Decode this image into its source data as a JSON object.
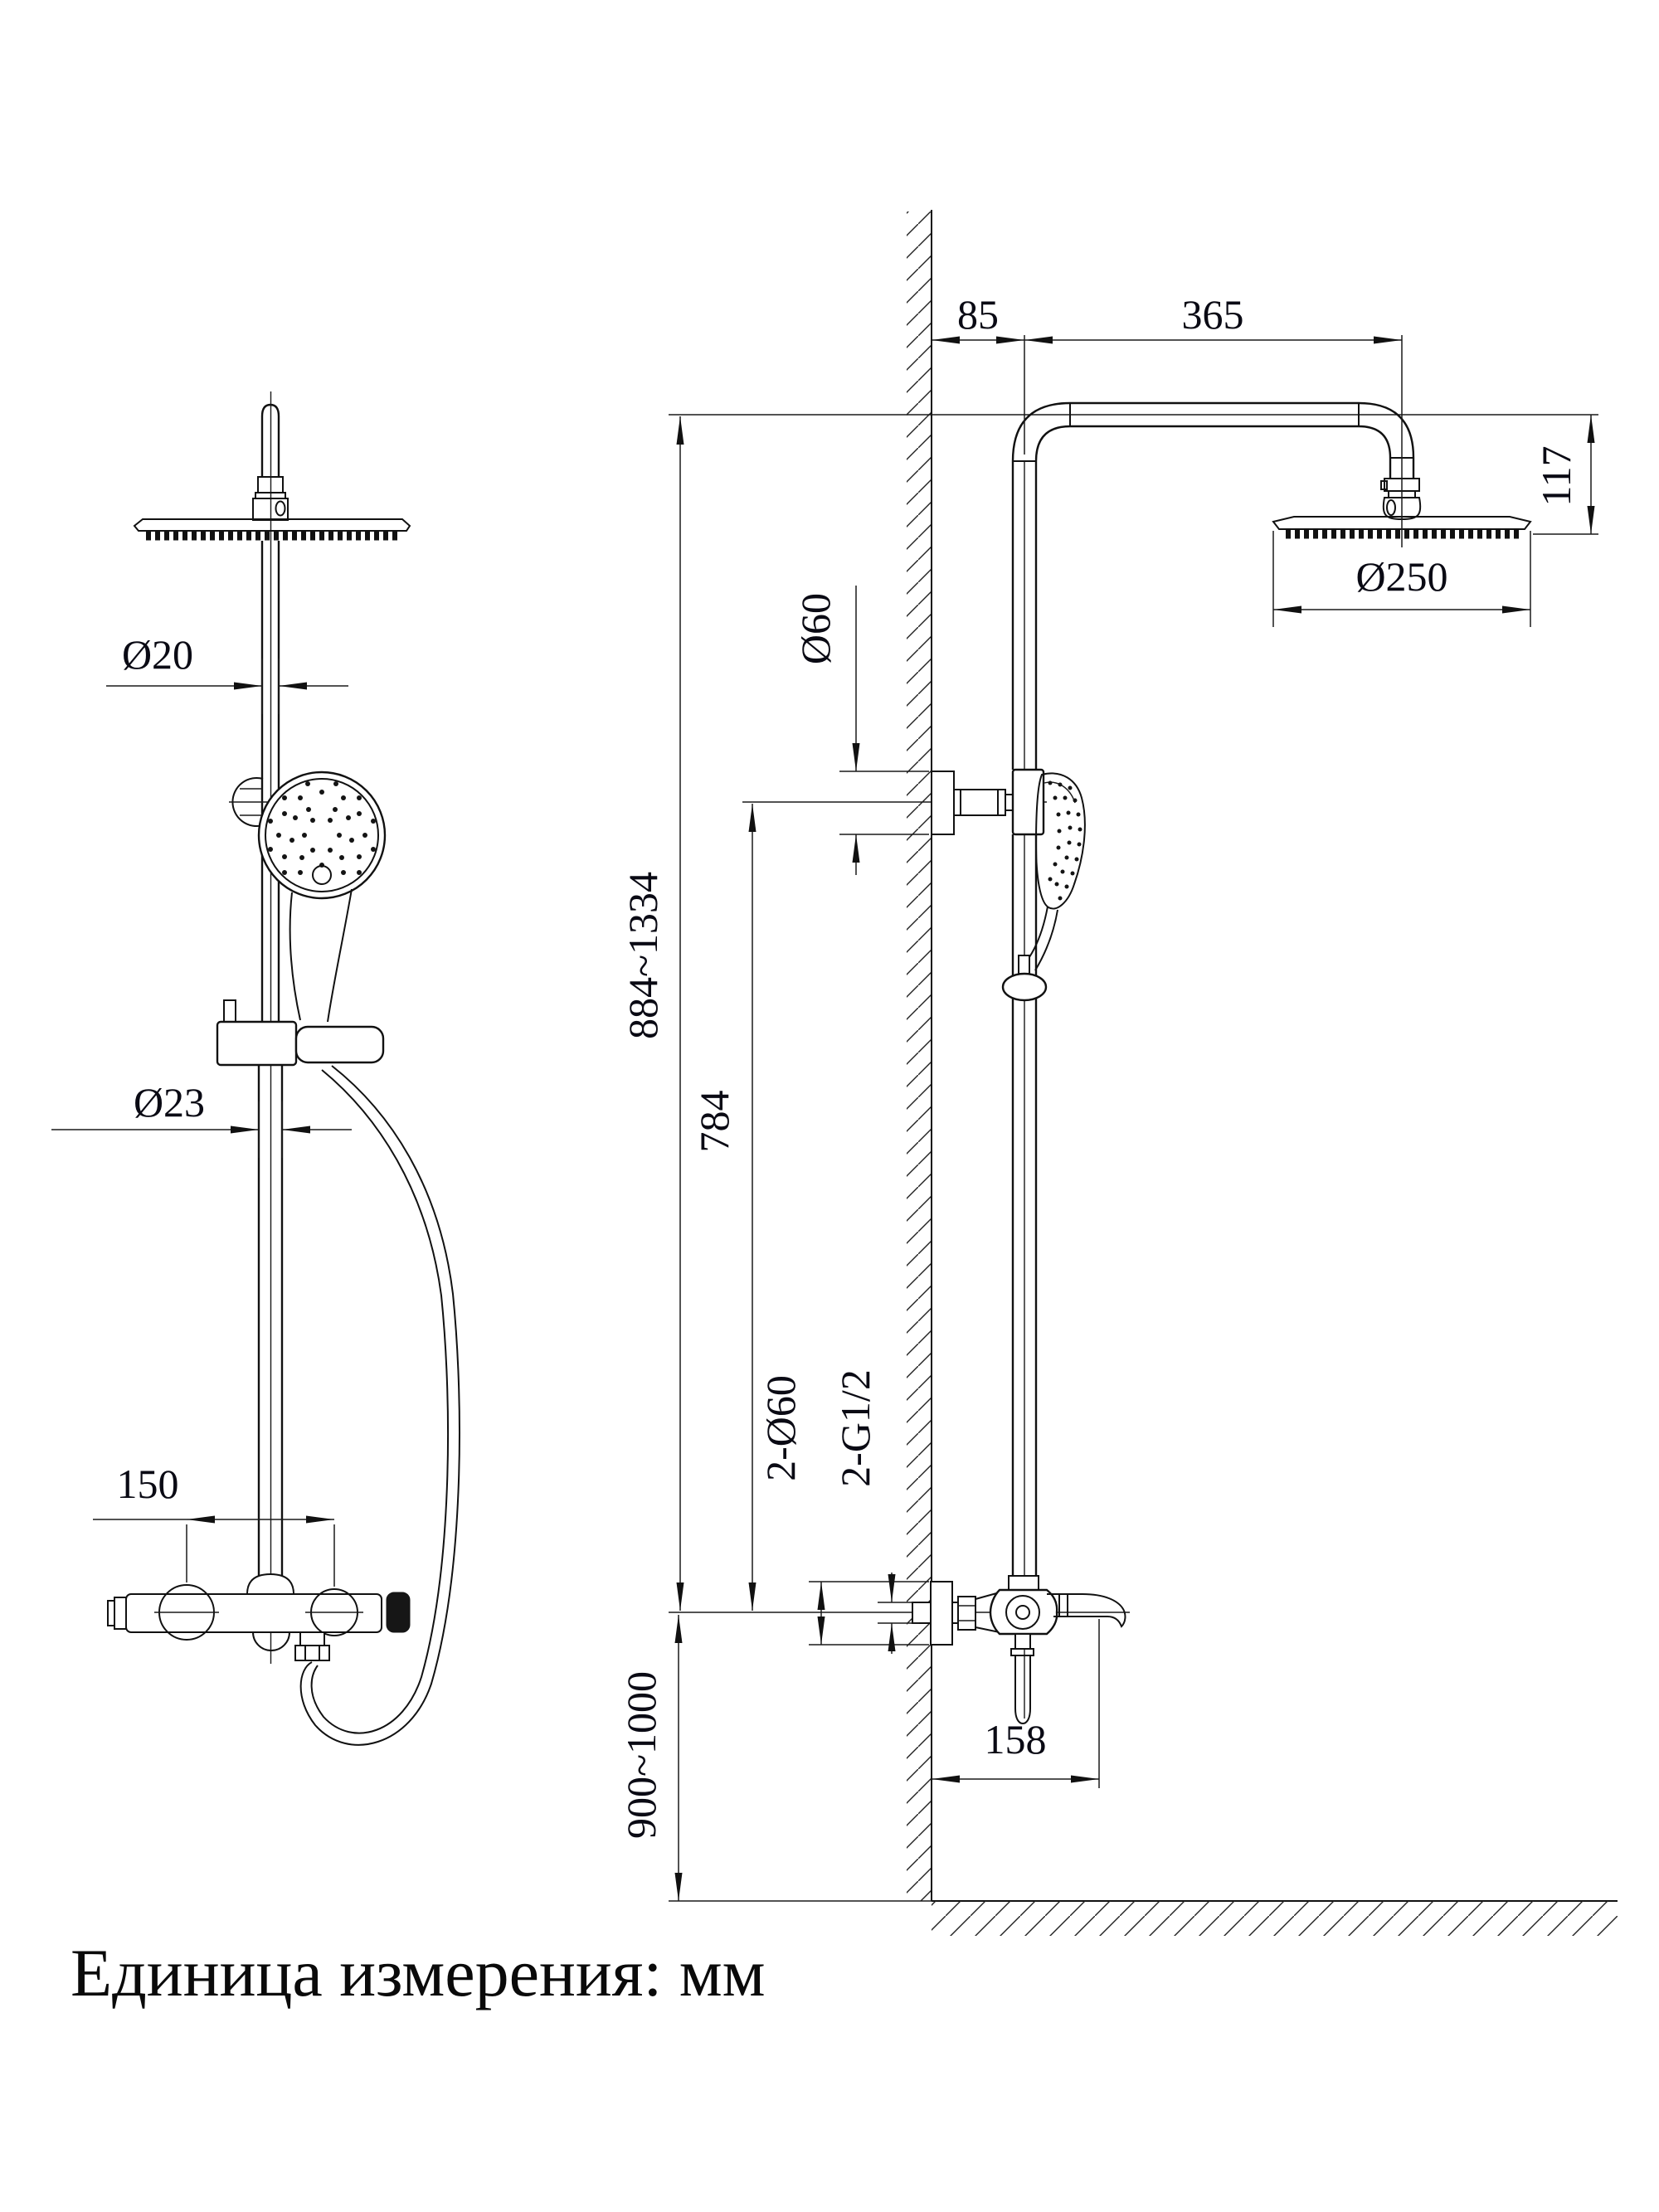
{
  "drawing": {
    "type": "technical-dimension-drawing",
    "subject": "shower column system, front view and wall-mounted side view",
    "unit_note": "Единица измерения: мм",
    "front_view": {
      "pipe_upper_dia": "Ø20",
      "pipe_lower_dia": "Ø23",
      "valve_center_distance": "150"
    },
    "side_view": {
      "wall_to_riser": "85",
      "riser_to_head": "365",
      "head_height": "117",
      "head_dia": "Ø250",
      "bracket_dia": "Ø60",
      "column_height_range": "884~1334",
      "bracket_to_mixer": "784",
      "escutcheon_dia": "2-Ø60",
      "thread_size": "2-G1/2",
      "mixer_mount_height": "900~1000",
      "spout_reach": "158"
    }
  }
}
